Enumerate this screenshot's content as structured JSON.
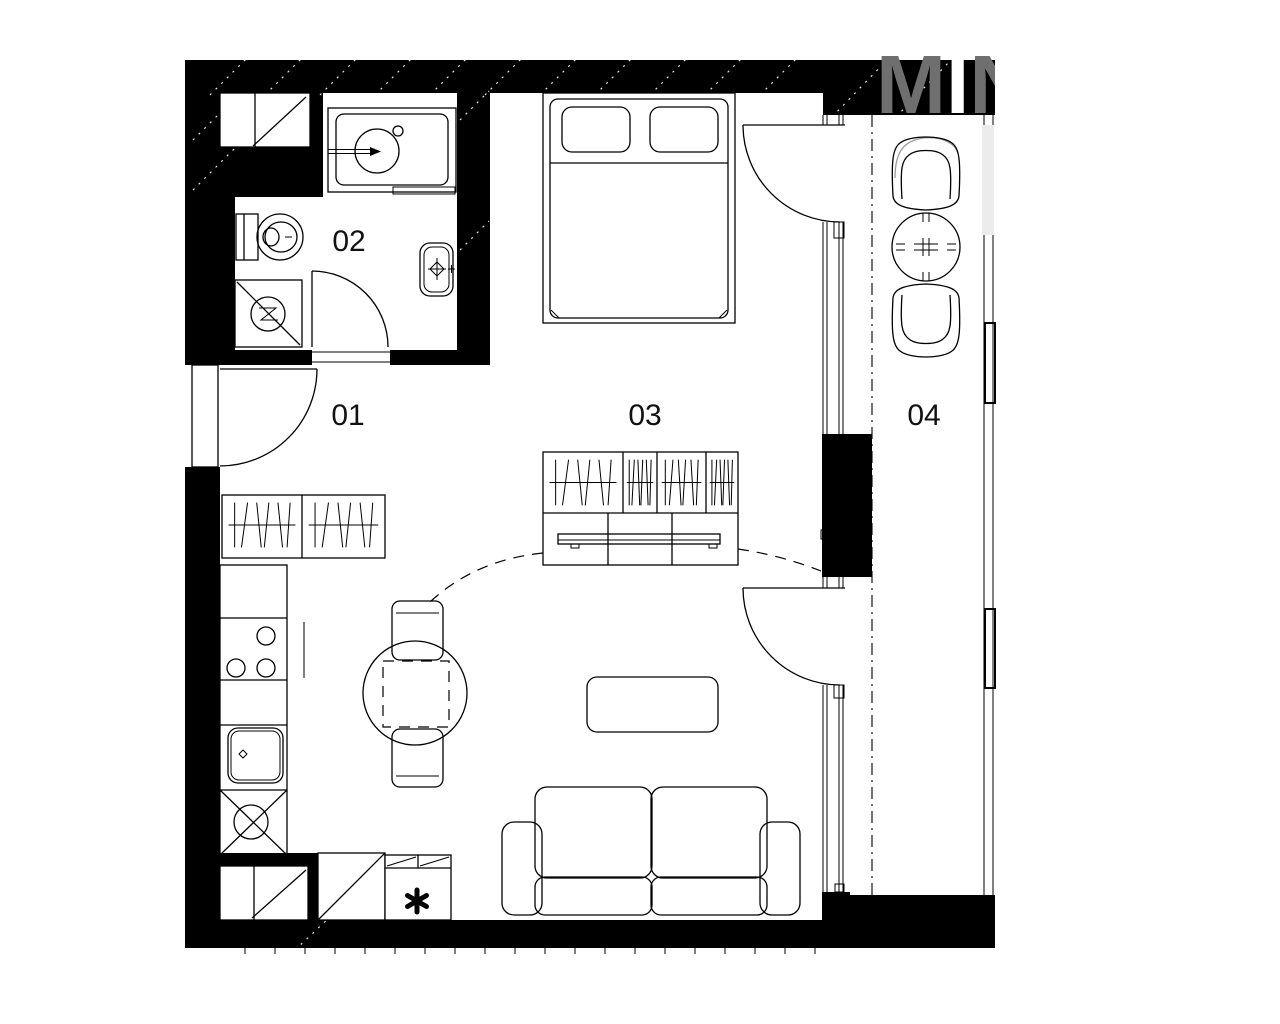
{
  "plan": {
    "kind": "studio-apartment-floor-plan",
    "background": "#ffffff",
    "wall_color": "#000000",
    "line_color": "#000000"
  },
  "rooms": [
    {
      "number": "01",
      "name": "entrance-hall"
    },
    {
      "number": "02",
      "name": "bathroom"
    },
    {
      "number": "03",
      "name": "living-room-bedroom"
    },
    {
      "number": "04",
      "name": "balcony"
    }
  ],
  "symbols": {
    "cabinet_note": "*"
  },
  "watermark": {
    "letters": [
      "M",
      "I",
      "N"
    ],
    "color": "#6f6f6f",
    "faint_color": "#ececec"
  },
  "fixtures": [
    "washing-machine-sink-unit",
    "toilet",
    "shower",
    "washbasin",
    "entrance-door",
    "bathroom-door",
    "hall-wardrobe",
    "kitchen-counter",
    "cooktop",
    "kitchen-sink",
    "base-cabinet-x",
    "dining-table",
    "dining-chair",
    "double-bed",
    "wardrobe-with-tv",
    "tv",
    "coffee-table",
    "sofa",
    "balcony-door",
    "balcony-chair",
    "balcony-table",
    "balcony-railing",
    "service-shaft",
    "storage-cabinet"
  ]
}
